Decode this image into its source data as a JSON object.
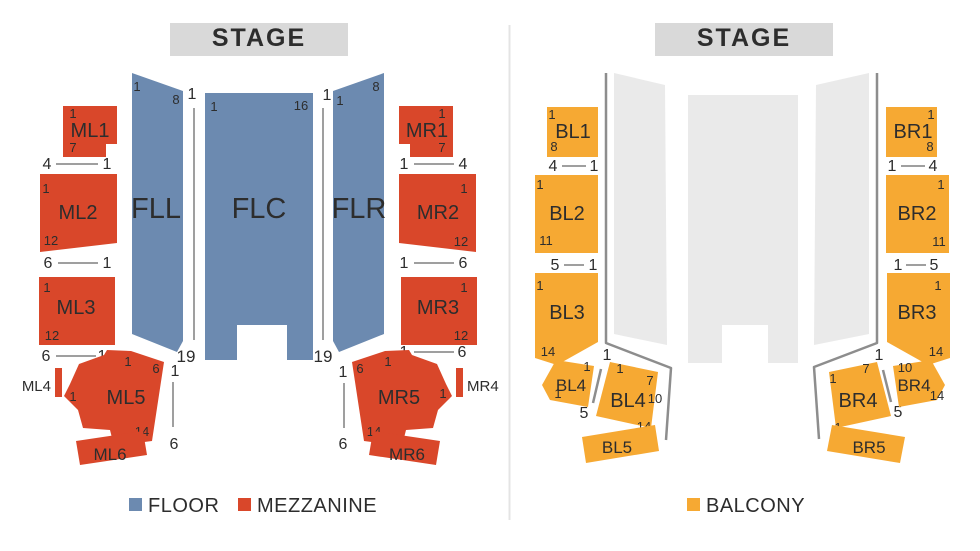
{
  "colors": {
    "floor": "#6c8ab0",
    "mezzanine": "#d9472a",
    "balcony": "#f6a933",
    "stage_bg": "#d9d9d9",
    "ghost": "#eaeaea",
    "outline": "#8d8d8d",
    "marker_line": "#9f9f9f",
    "divider": "#e4e4e4",
    "text": "#2d2d2d"
  },
  "left_map": {
    "stage_label": "STAGE",
    "legend": {
      "floor": "FLOOR",
      "mezzanine": "MEZZANINE"
    },
    "floor": {
      "fll": {
        "label": "FLL",
        "seat_left": "1",
        "seat_right": "8"
      },
      "flc": {
        "label": "FLC",
        "seat_left": "1",
        "seat_right": "16"
      },
      "flr": {
        "label": "FLR",
        "seat_left": "1",
        "seat_right": "8"
      },
      "aisle_left": {
        "row_first": "1",
        "row_last": "19"
      },
      "aisle_right": {
        "row_first": "1",
        "row_last": "19"
      }
    },
    "mezz": {
      "ml1": {
        "label": "ML1",
        "seat_first": "1",
        "seat_last": "7",
        "row": {
          "a": "4",
          "b": "1"
        }
      },
      "ml2": {
        "label": "ML2",
        "seat_first": "1",
        "seat_last": "12",
        "row": {
          "a": "6",
          "b": "1"
        }
      },
      "ml3": {
        "label": "ML3",
        "seat_first": "1",
        "seat_last": "12",
        "row": {
          "a": "6",
          "b": "1"
        }
      },
      "ml4": {
        "label": "ML4"
      },
      "ml5": {
        "label": "ML5",
        "num_top_left": "1",
        "num_top_right": "6",
        "num_left": "1",
        "num_bottom": "14",
        "aisle": {
          "top": "1",
          "bottom": "6"
        }
      },
      "ml6": {
        "label": "ML6"
      },
      "mr1": {
        "label": "MR1",
        "seat_first": "1",
        "seat_last": "7",
        "row": {
          "a": "1",
          "b": "4"
        }
      },
      "mr2": {
        "label": "MR2",
        "seat_first": "1",
        "seat_last": "12",
        "row": {
          "a": "1",
          "b": "6"
        }
      },
      "mr3": {
        "label": "MR3",
        "seat_first": "1",
        "seat_last": "12",
        "row": {
          "a": "1",
          "b": "6"
        }
      },
      "mr4": {
        "label": "MR4"
      },
      "mr5": {
        "label": "MR5",
        "num_top_left": "6",
        "num_top_right": "1",
        "num_right": "1",
        "num_bottom": "14",
        "aisle": {
          "top": "1",
          "bottom": "6"
        }
      },
      "mr6": {
        "label": "MR6"
      }
    }
  },
  "right_map": {
    "stage_label": "STAGE",
    "legend": {
      "balcony": "BALCONY"
    },
    "balcony": {
      "bl1": {
        "label": "BL1",
        "seat_first": "1",
        "seat_last": "8",
        "row": {
          "a": "4",
          "b": "1"
        }
      },
      "bl2": {
        "label": "BL2",
        "seat_first": "1",
        "seat_last": "11",
        "row": {
          "a": "5",
          "b": "1"
        }
      },
      "bl3": {
        "label": "BL3",
        "seat_first": "1",
        "seat_last": "14"
      },
      "bl4_front": {
        "label": "BL4",
        "num_top": "1",
        "num_left": "1",
        "num_below": "5"
      },
      "bl4_rear": {
        "label": "BL4",
        "num_above": "1",
        "num_top_left": "1",
        "num_top_right": "7",
        "num_right": "10",
        "num_bottom": "14"
      },
      "bl5": {
        "label": "BL5"
      },
      "br1": {
        "label": "BR1",
        "seat_first": "1",
        "seat_last": "8",
        "row": {
          "a": "1",
          "b": "4"
        }
      },
      "br2": {
        "label": "BR2",
        "seat_first": "1",
        "seat_last": "11",
        "row": {
          "a": "1",
          "b": "5"
        }
      },
      "br3": {
        "label": "BR3",
        "seat_first": "1",
        "seat_last": "14"
      },
      "br4_rear": {
        "label": "BR4",
        "num_above": "1",
        "num_left": "1",
        "num_top": "7",
        "num_bottom": "1",
        "num_below": "5"
      },
      "br4_front": {
        "label": "BR4",
        "num_top": "10",
        "num_bottom": "14"
      },
      "br5": {
        "label": "BR5"
      }
    }
  }
}
